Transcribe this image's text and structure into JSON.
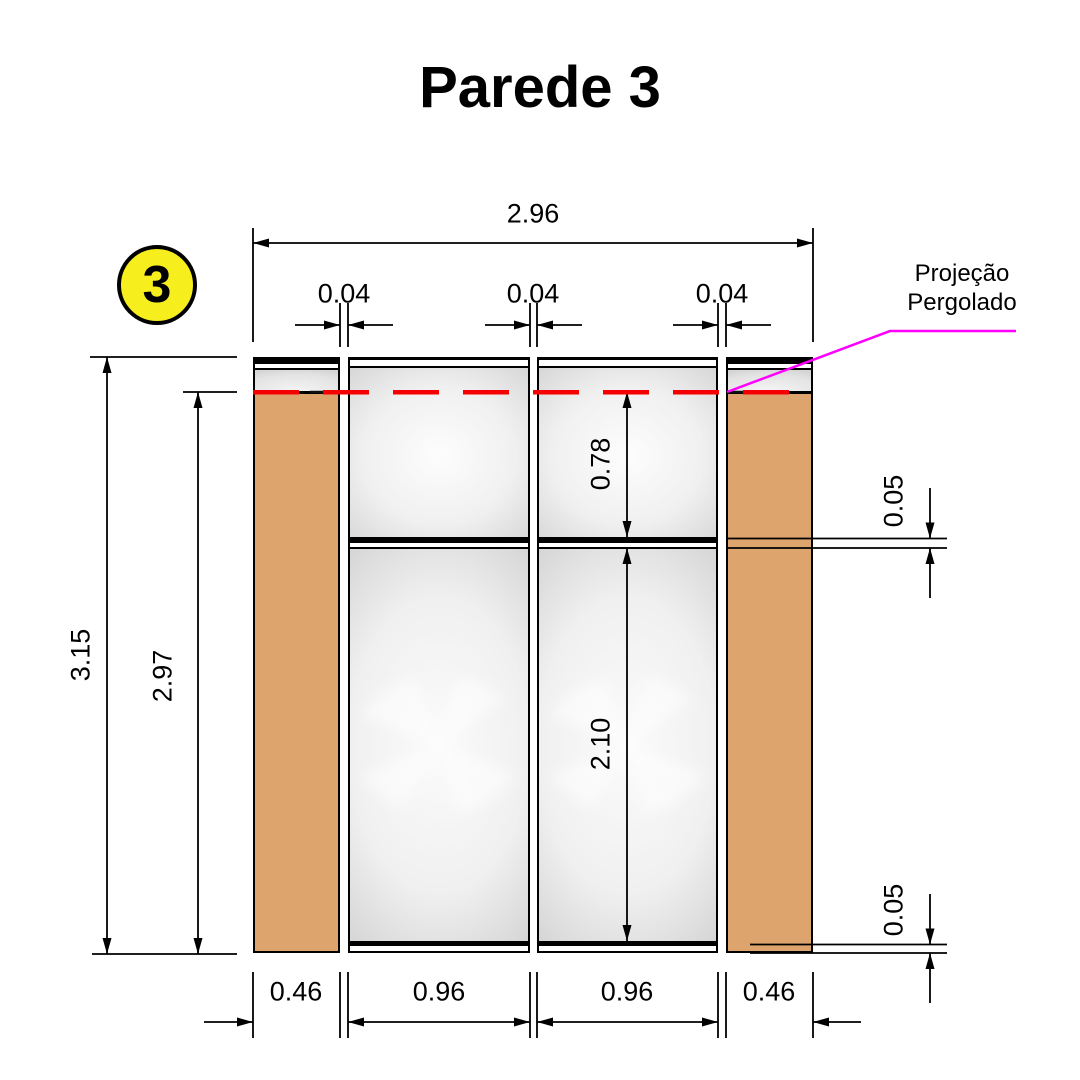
{
  "title": "Parede 3",
  "marker": {
    "number": "3"
  },
  "annotation": {
    "line1": "Projeção",
    "line2": "Pergolado"
  },
  "dimensions": {
    "total_width": "2.96",
    "gap_left": "0.04",
    "gap_center": "0.04",
    "gap_right": "0.04",
    "total_height": "3.15",
    "opening_height": "2.97",
    "upper_pane_height": "0.78",
    "lower_pane_height": "2.10",
    "transom_thickness": "0.05",
    "base_rail_thickness": "0.05",
    "bottom_left_column": "0.46",
    "bottom_left_glass": "0.96",
    "bottom_right_glass": "0.96",
    "bottom_right_column": "0.46"
  },
  "colors": {
    "column_fill": "#dda46e",
    "glass_edge": "#c6c6c6",
    "projection_line": "#f50000",
    "leader_line": "#ff00ff",
    "marker_fill": "#f7ee1e"
  }
}
